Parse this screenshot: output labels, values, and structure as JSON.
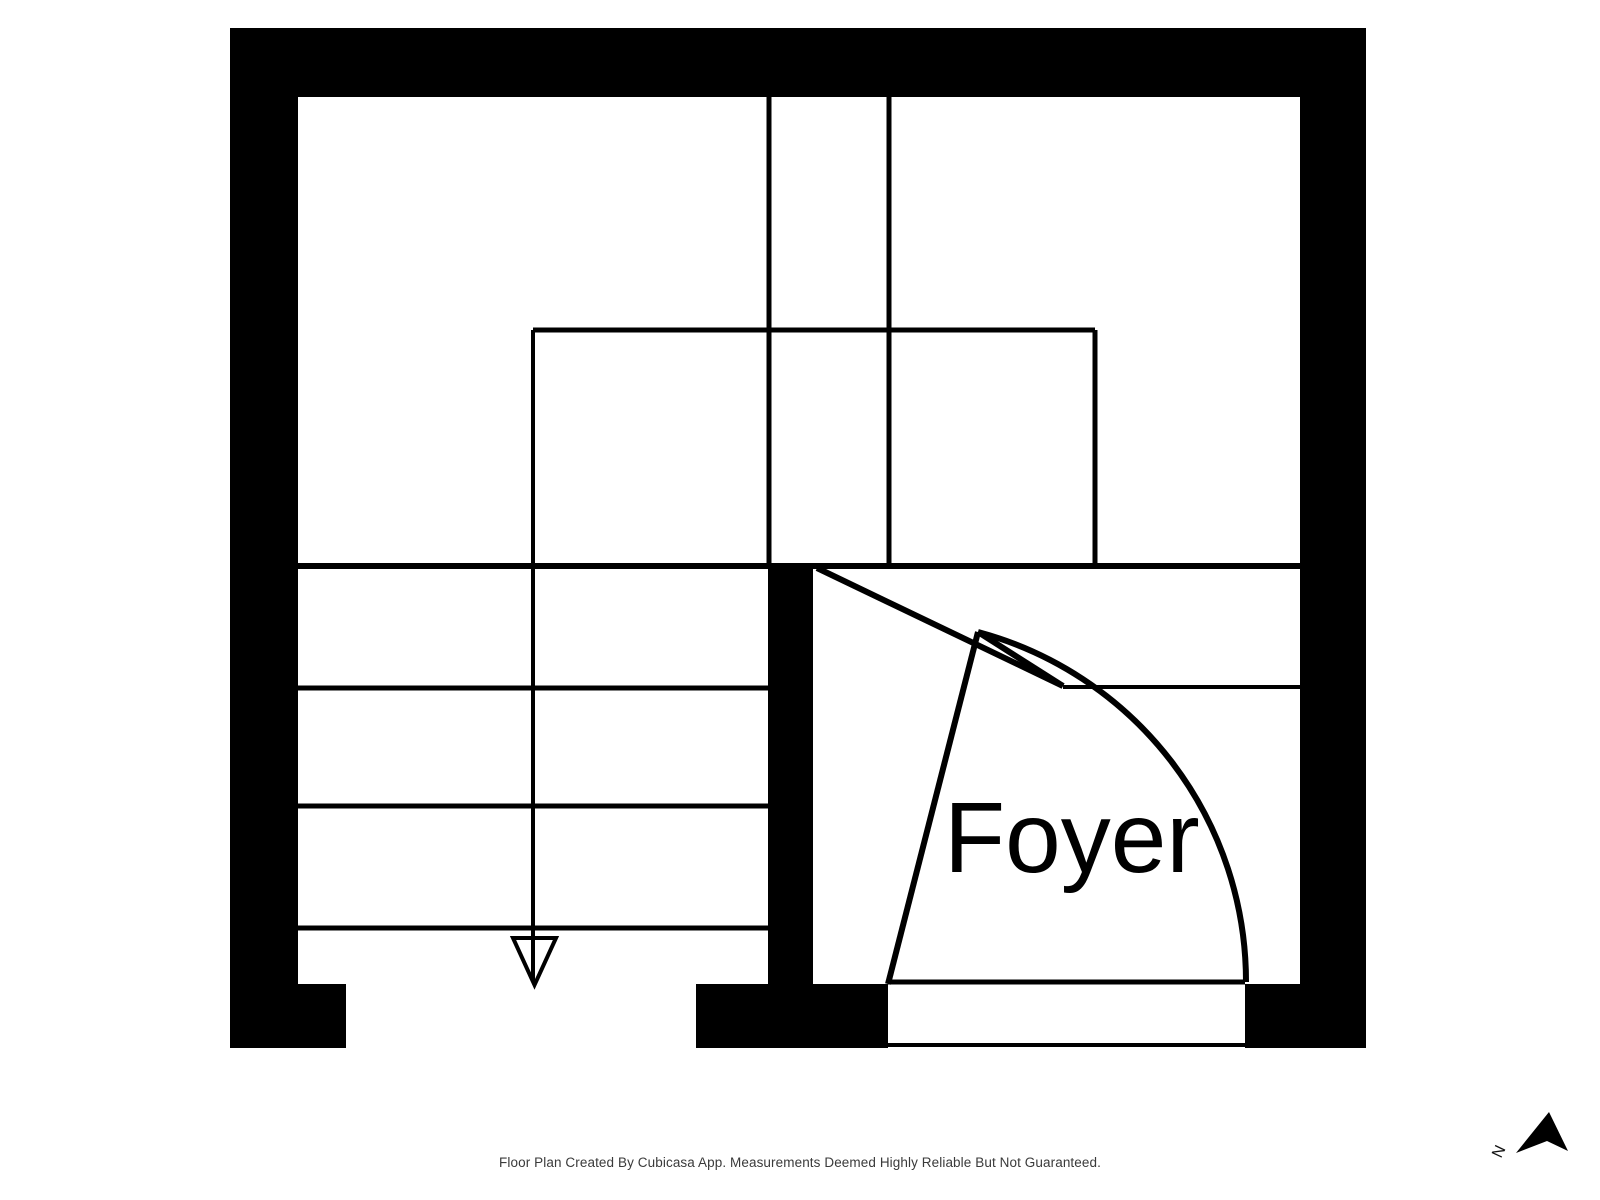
{
  "page": {
    "width": 1600,
    "height": 1200,
    "background": "#ffffff"
  },
  "floorplan": {
    "room_label": "Foyer",
    "compass_label": "N",
    "footer_text": "Floor Plan Created By Cubicasa App. Measurements Deemed Highly Reliable But Not Guaranteed.",
    "colors": {
      "wall": "#000000",
      "line": "#000000",
      "label": "#000000",
      "footer": "#3a3a3a",
      "background": "#ffffff"
    },
    "walls": [
      {
        "name": "wall-top",
        "x": 230,
        "y": 28,
        "w": 1136,
        "h": 69
      },
      {
        "name": "wall-left",
        "x": 230,
        "y": 28,
        "w": 68,
        "h": 1020
      },
      {
        "name": "wall-right",
        "x": 1300,
        "y": 28,
        "w": 66,
        "h": 1020
      },
      {
        "name": "wall-foyer-left",
        "x": 768,
        "y": 566,
        "w": 45,
        "h": 482
      },
      {
        "name": "wall-bottom-left",
        "x": 298,
        "y": 984,
        "w": 48,
        "h": 64
      },
      {
        "name": "wall-bottom-middle",
        "x": 696,
        "y": 984,
        "w": 192,
        "h": 64
      },
      {
        "name": "wall-bottom-right",
        "x": 1245,
        "y": 984,
        "w": 121,
        "h": 64
      }
    ],
    "thin_lines": [
      {
        "name": "divider-line",
        "x1": 298,
        "y1": 566,
        "x2": 1300,
        "y2": 566,
        "w": 6
      },
      {
        "name": "stair-tread-1",
        "x1": 298,
        "y1": 688,
        "x2": 768,
        "y2": 688,
        "w": 5
      },
      {
        "name": "stair-tread-2",
        "x1": 298,
        "y1": 806,
        "x2": 768,
        "y2": 806,
        "w": 5
      },
      {
        "name": "stair-tread-3",
        "x1": 298,
        "y1": 928,
        "x2": 768,
        "y2": 928,
        "w": 5
      },
      {
        "name": "room-line-left",
        "x1": 769,
        "y1": 97,
        "x2": 769,
        "y2": 566,
        "w": 5
      },
      {
        "name": "room-line-right",
        "x1": 889,
        "y1": 97,
        "x2": 889,
        "y2": 566,
        "w": 5
      },
      {
        "name": "stairwell-rect-top",
        "x1": 533,
        "y1": 330,
        "x2": 1095,
        "y2": 330,
        "w": 5
      },
      {
        "name": "stairwell-rect-right",
        "x1": 1095,
        "y1": 330,
        "x2": 1095,
        "y2": 566,
        "w": 5
      },
      {
        "name": "stair-direction-line",
        "x1": 533,
        "y1": 330,
        "x2": 533,
        "y2": 982,
        "w": 4
      },
      {
        "name": "closet-line",
        "x1": 1063,
        "y1": 687,
        "x2": 1300,
        "y2": 687,
        "w": 4
      },
      {
        "name": "threshold-top-line",
        "x1": 888,
        "y1": 982,
        "x2": 1245,
        "y2": 982,
        "w": 5
      },
      {
        "name": "threshold-bottom-line",
        "x1": 888,
        "y1": 1045,
        "x2": 1245,
        "y2": 1045,
        "w": 4
      }
    ],
    "door": {
      "lines": [
        {
          "name": "door-leaf-line",
          "x1": 888,
          "y1": 984,
          "x2": 978,
          "y2": 632,
          "w": 6
        },
        {
          "name": "door-frame-line",
          "x1": 817,
          "y1": 568,
          "x2": 1063,
          "y2": 686,
          "w": 6
        },
        {
          "name": "door-panel-line",
          "x1": 978,
          "y1": 632,
          "x2": 1063,
          "y2": 686,
          "w": 6
        }
      ],
      "swing_arc_path": "M 1246 982 A 362 362 0 0 0 978 632",
      "arc_stroke": 6
    },
    "stairs": {
      "arrowhead_points": "513,938 556,938 534.5,985",
      "arrowhead_stroke": 4
    },
    "compass": {
      "arrow_points": "1549,1112 1568,1151 1547,1141 1516,1153"
    }
  }
}
